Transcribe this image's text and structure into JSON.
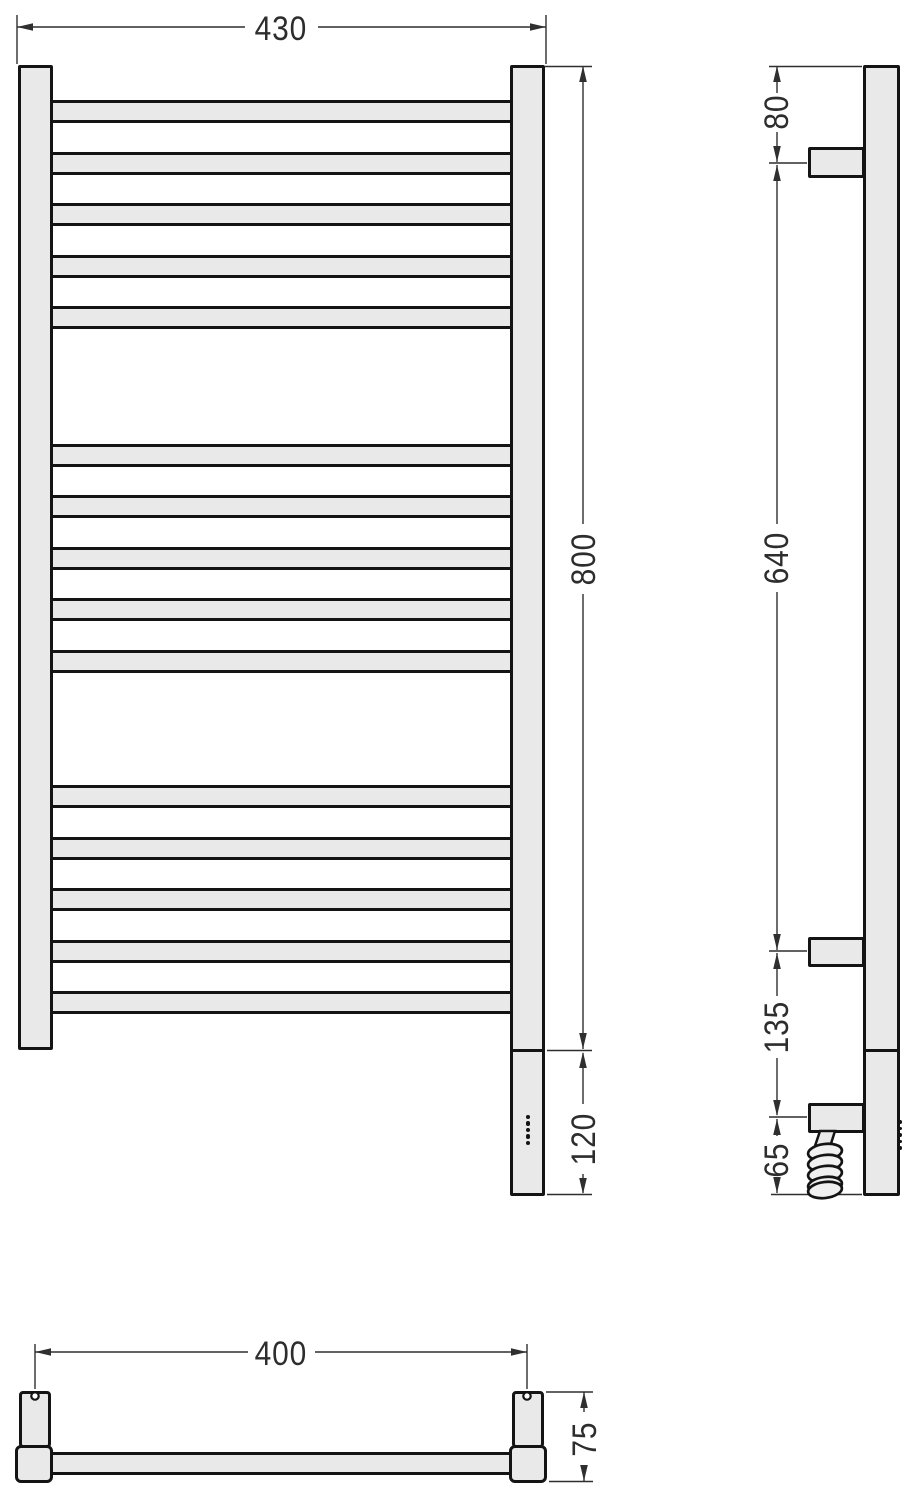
{
  "dim_labels": {
    "front_width": "430",
    "front_height": "800",
    "front_heater_section": "120",
    "side_top_to_bracket": "80",
    "side_bracket_span": "640",
    "side_bracket_to_heater": "135",
    "side_heater_to_bottom": "65",
    "top_mounting_span": "400",
    "top_depth": "75"
  },
  "front_rungs": {
    "left": 50,
    "width": 463,
    "height": 23,
    "tops": [
      100,
      151.5,
      203,
      254.5,
      306,
      443.5,
      495,
      546.5,
      598,
      649.5,
      785,
      836.5,
      888,
      939.5,
      991
    ]
  },
  "indicator_dots": {
    "front": {
      "cx": 528,
      "cy_start": 1117,
      "step": 6.5,
      "count": 5,
      "r": 2.3
    },
    "side": {
      "cx": 900,
      "cy_start": 1122,
      "step": 6.5,
      "count": 5,
      "r": 1.8
    }
  },
  "colors": {
    "fill": "#e9e9e9",
    "outline": "#141414",
    "dim_line": "#2f2f2f",
    "label_text": "#2d2d2d",
    "background": "#ffffff"
  }
}
